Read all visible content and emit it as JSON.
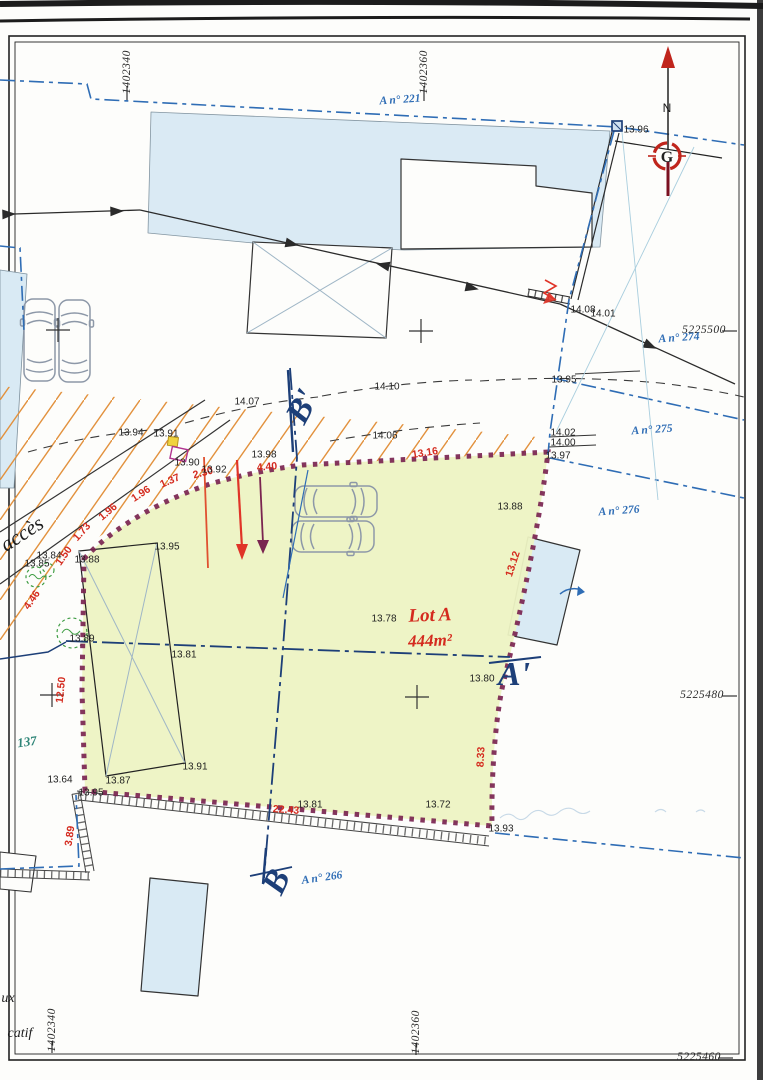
{
  "colors": {
    "lot_fill": "#edf3c3",
    "building_fill": "#d9eaf4",
    "boundary_purple": "#7a2450",
    "parcel_blue": "#2f6db5",
    "section_navy": "#1d3f78",
    "hatch_orange": "#e2913d",
    "measure_red": "#d42a1e",
    "tree_green": "#3f9d44"
  },
  "lot": {
    "name": "Lot A",
    "area": "444m²"
  },
  "compass": {
    "north_label": "N",
    "logo_letter": "G"
  },
  "frame_coords": [
    {
      "text": "1402340",
      "x": 127,
      "y": 72,
      "rot": -90
    },
    {
      "text": "1402360",
      "x": 424,
      "y": 72,
      "rot": -90
    },
    {
      "text": "5225500",
      "x": 704,
      "y": 330,
      "rot": 0
    },
    {
      "text": "5225480",
      "x": 702,
      "y": 695,
      "rot": 0
    },
    {
      "text": "1402340",
      "x": 52,
      "y": 1030,
      "rot": -90
    },
    {
      "text": "1402360",
      "x": 416,
      "y": 1032,
      "rot": -90
    },
    {
      "text": "5225460",
      "x": 699,
      "y": 1057,
      "rot": 0
    }
  ],
  "parcel_labels": [
    {
      "text": "A n° 221",
      "x": 400,
      "y": 100,
      "rot": -4
    },
    {
      "text": "A n° 274",
      "x": 679,
      "y": 338,
      "rot": -4
    },
    {
      "text": "A n° 275",
      "x": 652,
      "y": 430,
      "rot": -4
    },
    {
      "text": "A n° 276",
      "x": 619,
      "y": 511,
      "rot": -4
    },
    {
      "text": "A n° 266",
      "x": 322,
      "y": 878,
      "rot": -8
    }
  ],
  "section_labels": [
    {
      "text": "B'",
      "x": 303,
      "y": 407,
      "rot": -62
    },
    {
      "text": "A'",
      "x": 514,
      "y": 675,
      "rot": 0
    },
    {
      "text": "B",
      "x": 277,
      "y": 882,
      "rot": -65
    }
  ],
  "annotations": [
    {
      "text": "accès",
      "x": 22,
      "y": 534,
      "rot": -33,
      "cls": "note-black"
    },
    {
      "text": "137",
      "x": 27,
      "y": 742,
      "rot": -8,
      "cls": "note-teal"
    },
    {
      "text": "ux",
      "x": 8,
      "y": 999,
      "rot": 0,
      "cls": "note-frag"
    },
    {
      "text": "catif",
      "x": 20,
      "y": 1034,
      "rot": 0,
      "cls": "note-frag"
    }
  ],
  "red_measures": [
    {
      "text": "1.50",
      "x": 64,
      "y": 556,
      "rot": -55
    },
    {
      "text": "1.73",
      "x": 82,
      "y": 532,
      "rot": -48
    },
    {
      "text": "1.96",
      "x": 108,
      "y": 512,
      "rot": -40
    },
    {
      "text": "1.96",
      "x": 141,
      "y": 494,
      "rot": -33
    },
    {
      "text": "1.37",
      "x": 170,
      "y": 481,
      "rot": -24
    },
    {
      "text": "2.30",
      "x": 203,
      "y": 473,
      "rot": -15
    },
    {
      "text": "4.40",
      "x": 267,
      "y": 467,
      "rot": -5
    },
    {
      "text": "13.16",
      "x": 425,
      "y": 453,
      "rot": -9
    },
    {
      "text": "13.12",
      "x": 513,
      "y": 564,
      "rot": -72
    },
    {
      "text": "8.33",
      "x": 481,
      "y": 757,
      "rot": -87
    },
    {
      "text": "22.43",
      "x": 286,
      "y": 810,
      "rot": 4
    },
    {
      "text": "3.89",
      "x": 70,
      "y": 836,
      "rot": -82
    },
    {
      "text": "12.50",
      "x": 61,
      "y": 690,
      "rot": -84
    },
    {
      "text": "4.46",
      "x": 32,
      "y": 600,
      "rot": -55
    }
  ],
  "spot_heights": [
    {
      "text": "13.96",
      "x": 636,
      "y": 130
    },
    {
      "text": "14.08",
      "x": 583,
      "y": 310
    },
    {
      "text": "14.01",
      "x": 603,
      "y": 314
    },
    {
      "text": "13.95",
      "x": 564,
      "y": 380
    },
    {
      "text": "14.02",
      "x": 563,
      "y": 433
    },
    {
      "text": "14.00",
      "x": 563,
      "y": 443
    },
    {
      "text": "13.97",
      "x": 558,
      "y": 456
    },
    {
      "text": "14.07",
      "x": 247,
      "y": 402
    },
    {
      "text": "14.10",
      "x": 387,
      "y": 387
    },
    {
      "text": "14.06",
      "x": 385,
      "y": 436
    },
    {
      "text": "13.94",
      "x": 131,
      "y": 433
    },
    {
      "text": "13.91",
      "x": 166,
      "y": 434
    },
    {
      "text": "13.90",
      "x": 187,
      "y": 463
    },
    {
      "text": "13.92",
      "x": 214,
      "y": 470
    },
    {
      "text": "13.98",
      "x": 264,
      "y": 455
    },
    {
      "text": "13.88",
      "x": 87,
      "y": 560
    },
    {
      "text": "13.84",
      "x": 49,
      "y": 556
    },
    {
      "text": "13.85",
      "x": 37,
      "y": 564
    },
    {
      "text": "13.95",
      "x": 167,
      "y": 547
    },
    {
      "text": "13.88",
      "x": 510,
      "y": 507
    },
    {
      "text": "13.89",
      "x": 82,
      "y": 639
    },
    {
      "text": "13.81",
      "x": 184,
      "y": 655
    },
    {
      "text": "13.78",
      "x": 384,
      "y": 619
    },
    {
      "text": "13.80",
      "x": 482,
      "y": 679
    },
    {
      "text": "13.91",
      "x": 195,
      "y": 767
    },
    {
      "text": "13.87",
      "x": 118,
      "y": 781
    },
    {
      "text": "13.64",
      "x": 60,
      "y": 780
    },
    {
      "text": "13.95",
      "x": 91,
      "y": 793
    },
    {
      "text": "13.81",
      "x": 310,
      "y": 805
    },
    {
      "text": "13.72",
      "x": 438,
      "y": 805
    },
    {
      "text": "13.93",
      "x": 501,
      "y": 829
    }
  ]
}
